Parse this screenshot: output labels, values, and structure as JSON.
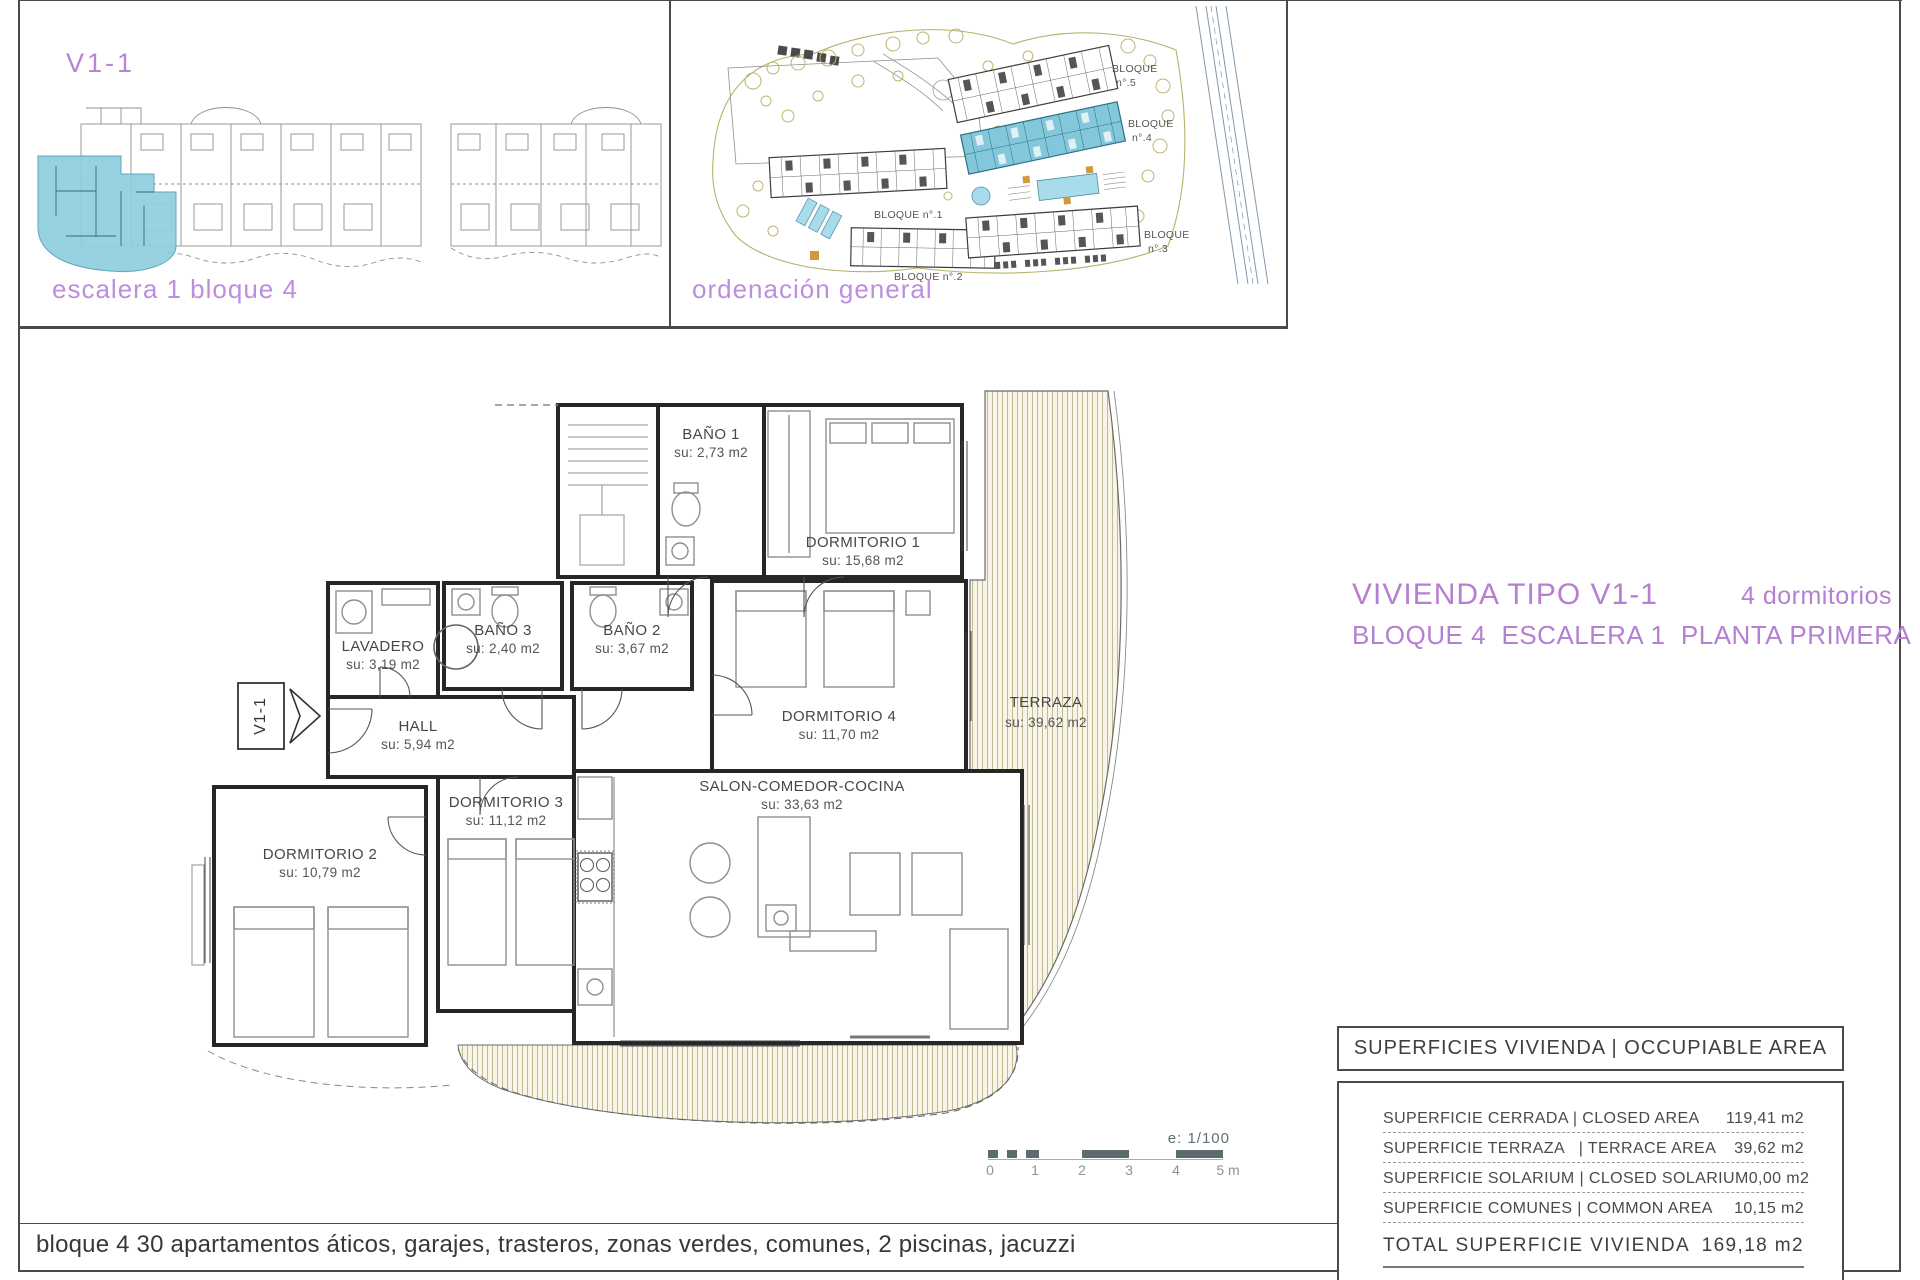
{
  "page": {
    "bottom_caption": "bloque 4 30 apartamentos áticos, garajes, trasteros, zonas verdes, comunes, 2 piscinas, jacuzzi"
  },
  "unit_locator": {
    "code": "V1-1",
    "caption": "escalera 1 bloque 4"
  },
  "site_plan": {
    "caption": "ordenación general",
    "block_labels": [
      {
        "line1": "BLOQUE",
        "line2": "n°.5"
      },
      {
        "line1": "BLOQUE",
        "line2": "n°.4"
      },
      {
        "line1": "BLOQUE n°.1",
        "line2": ""
      },
      {
        "line1": "BLOQUE n°.2",
        "line2": ""
      },
      {
        "line1": "BLOQUE",
        "line2": "n°.3"
      }
    ]
  },
  "title_block": {
    "line1_left": "VIVIENDA TIPO V1-1",
    "line1_right": "4 dormitorios",
    "line2": "BLOQUE 4  ESCALERA 1  PLANTA PRIMERA"
  },
  "floor_plan": {
    "unit_tag": "V1-1",
    "rooms": [
      {
        "name": "BAÑO 1",
        "area": "su: 2,73 m2"
      },
      {
        "name": "DORMITORIO 1",
        "area": "su: 15,68 m2"
      },
      {
        "name": "LAVADERO",
        "area": "su: 3,19 m2"
      },
      {
        "name": "BAÑO 3",
        "area": "su: 2,40 m2"
      },
      {
        "name": "BAÑO 2",
        "area": "su: 3,67 m2"
      },
      {
        "name": "HALL",
        "area": "su: 5,94 m2"
      },
      {
        "name": "DORMITORIO 4",
        "area": "su: 11,70 m2"
      },
      {
        "name": "TERRAZA",
        "area": "su: 39,62 m2"
      },
      {
        "name": "DORMITORIO 3",
        "area": "su: 11,12 m2"
      },
      {
        "name": "SALON-COMEDOR-COCINA",
        "area": "su: 33,63 m2"
      },
      {
        "name": "DORMITORIO 2",
        "area": "su: 10,79 m2"
      }
    ]
  },
  "scale_bar": {
    "ratio": "e: 1/100",
    "ticks": [
      "0",
      "1",
      "2",
      "3",
      "4",
      "5 m"
    ]
  },
  "area_table": {
    "header": "SUPERFICIES VIVIENDA | OCCUPIABLE AREA",
    "rows": [
      {
        "label": "SUPERFICIE CERRADA | CLOSED AREA",
        "value": "119,41 m2"
      },
      {
        "label": "SUPERFICIE TERRAZA   | TERRACE AREA",
        "value": "39,62 m2"
      },
      {
        "label": "SUPERFICIE SOLARIUM | CLOSED SOLARIUM",
        "value": "0,00 m2"
      },
      {
        "label": "SUPERFICIE COMUNES | COMMON AREA",
        "value": "10,15 m2"
      }
    ],
    "total": {
      "label": "TOTAL SUPERFICIE VIVIENDA",
      "value": "169,18 m2"
    }
  },
  "colors": {
    "accent_purple": "#b57fd2",
    "caption_purple": "#bd8ede",
    "highlight_blue": "#8fcede",
    "pool_blue": "#a8dcec",
    "hatch_line_olive": "#bcb389",
    "hatch_bg": "#f8f5e8",
    "tree_olive": "#bdb571",
    "scalebar_slate": "#5c6b6e"
  }
}
